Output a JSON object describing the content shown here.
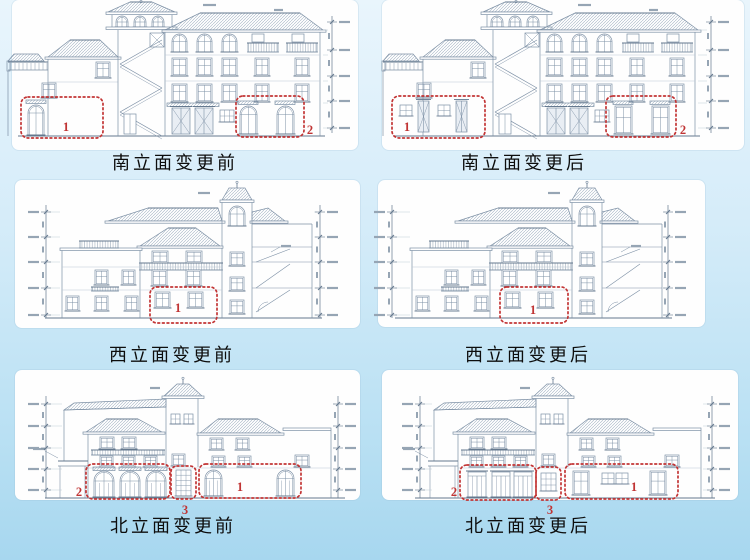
{
  "slide": {
    "background_top": "#e9f5fc",
    "background_bottom": "#a7d7ef",
    "card_color": "#fefefe",
    "marker_color": "#c03434",
    "drawing_line_color": "#7d90a5"
  },
  "panels": [
    {
      "id": "south-before",
      "caption": "南立面变更前",
      "markers": [
        {
          "label": "1"
        },
        {
          "label": "2"
        }
      ]
    },
    {
      "id": "south-after",
      "caption": "南立面变更后",
      "markers": [
        {
          "label": "1"
        },
        {
          "label": "2"
        }
      ]
    },
    {
      "id": "west-before",
      "caption": "西立面变更前",
      "markers": [
        {
          "label": "1"
        }
      ]
    },
    {
      "id": "west-after",
      "caption": "西立面变更后",
      "markers": [
        {
          "label": "1"
        }
      ]
    },
    {
      "id": "north-before",
      "caption": "北立面变更前",
      "markers": [
        {
          "label": "2"
        },
        {
          "label": "3"
        },
        {
          "label": "1"
        }
      ]
    },
    {
      "id": "north-after",
      "caption": "北立面变更后",
      "markers": [
        {
          "label": "2"
        },
        {
          "label": "3"
        },
        {
          "label": "1"
        }
      ]
    }
  ]
}
